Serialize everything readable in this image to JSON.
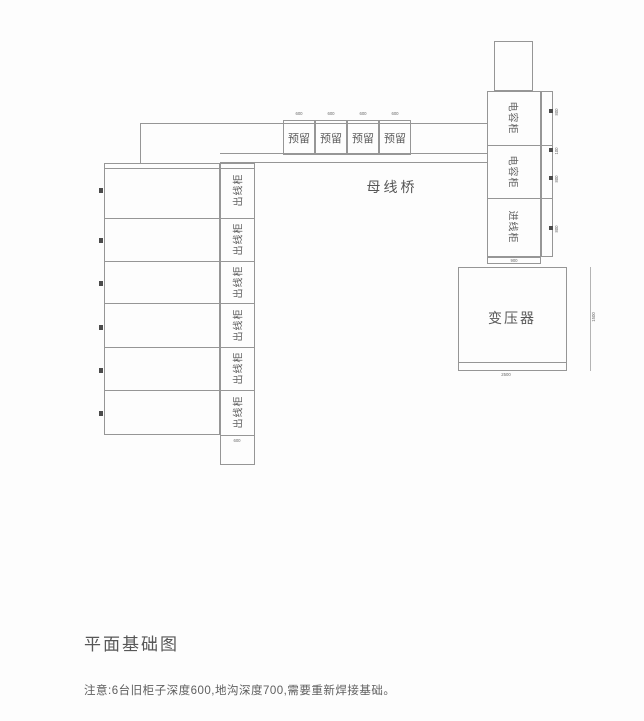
{
  "drawing": {
    "title": "平面基础图",
    "note": "注意:6台旧柜子深度600,地沟深度700,需要重新焊接基础。",
    "busbar_bridge_label": "母线桥",
    "transformer_label": "变压器",
    "left_cabinets": [
      {
        "label": "出线柜"
      },
      {
        "label": "出线柜"
      },
      {
        "label": "出线柜"
      },
      {
        "label": "出线柜"
      },
      {
        "label": "出线柜"
      },
      {
        "label": "出线柜"
      }
    ],
    "reserved_slots": [
      {
        "label": "预留"
      },
      {
        "label": "预留"
      },
      {
        "label": "预留"
      },
      {
        "label": "预留"
      }
    ],
    "right_cabinets": [
      {
        "label": "电容柜"
      },
      {
        "label": "电容柜"
      },
      {
        "label": "进线柜"
      }
    ],
    "dims": {
      "reserved": [
        "600",
        "600",
        "600",
        "600"
      ],
      "left_column_bottom": "600",
      "right_cabinet_sides": [
        "800",
        "100",
        "800",
        "800"
      ],
      "right_column_bottom": "900",
      "transformer_bottom": "2500",
      "transformer_right": "1500"
    },
    "colors": {
      "line": "#969696",
      "text": "#5a5a5a",
      "tick": "#4b4b4b"
    }
  }
}
